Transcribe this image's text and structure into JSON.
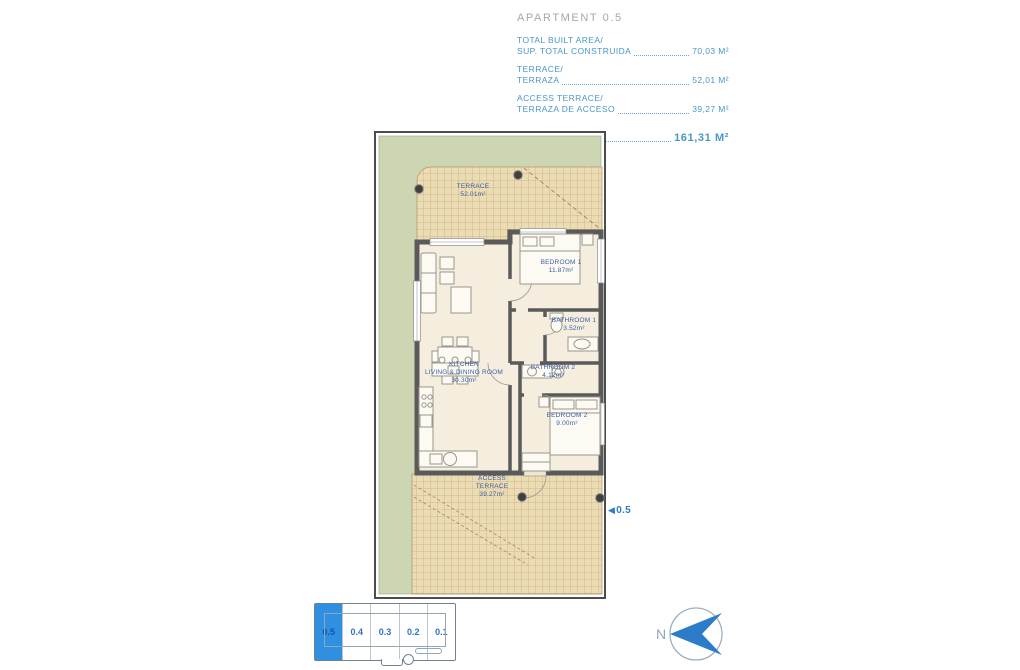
{
  "header": {
    "title": "APARTMENT 0.5",
    "rows": [
      {
        "label_en": "TOTAL BUILT AREA/",
        "label_es": "SUP. TOTAL CONSTRUIDA",
        "value": "70,03 M²"
      },
      {
        "label_en": "TERRACE/",
        "label_es": "TERRAZA",
        "value": "52,01 M²"
      },
      {
        "label_en": "ACCESS TERRACE/",
        "label_es": "TERRAZA DE ACCESO",
        "value": "39,27 M²"
      }
    ],
    "total_label": "TOTAL",
    "total_value": "161,31 M²"
  },
  "plan": {
    "rooms": [
      {
        "line1": "TERRACE",
        "area": "52.01m²"
      },
      {
        "line1": "BEDROOM 1",
        "area": "11.87m²"
      },
      {
        "line1": "BATHROOM 1",
        "area": "3.52m²"
      },
      {
        "line1": "KITCHEN",
        "line2": "LIVING & DINING ROOM",
        "area": "30.30m²"
      },
      {
        "line1": "BATHROOM 2",
        "area": "4.12m²"
      },
      {
        "line1": "BEDROOM 2",
        "area": "9.00m²"
      },
      {
        "line1": "ACCESS",
        "line2": "TERRACE",
        "area": "39.27m²"
      }
    ],
    "entrance_label": "0.5",
    "entrance_arrow": "◀"
  },
  "keyplan": {
    "units": [
      {
        "label": "0.5",
        "highlighted": true
      },
      {
        "label": "0.4",
        "highlighted": false
      },
      {
        "label": "0.3",
        "highlighted": false
      },
      {
        "label": "0.2",
        "highlighted": false
      },
      {
        "label": "0.1",
        "highlighted": false
      }
    ]
  },
  "compass": {
    "label": "N"
  },
  "colors": {
    "accent_blue": "#2b7cc9",
    "spec_blue": "#4b97c4",
    "title_gray": "#9fa8ac",
    "garden_green": "#ccd6b2",
    "hatch_tan": "#ecdcb4",
    "wall_gray": "#5a5a5a",
    "room_label_blue": "#3a5fa8",
    "keyplan_highlight": "#2f8fe0"
  }
}
